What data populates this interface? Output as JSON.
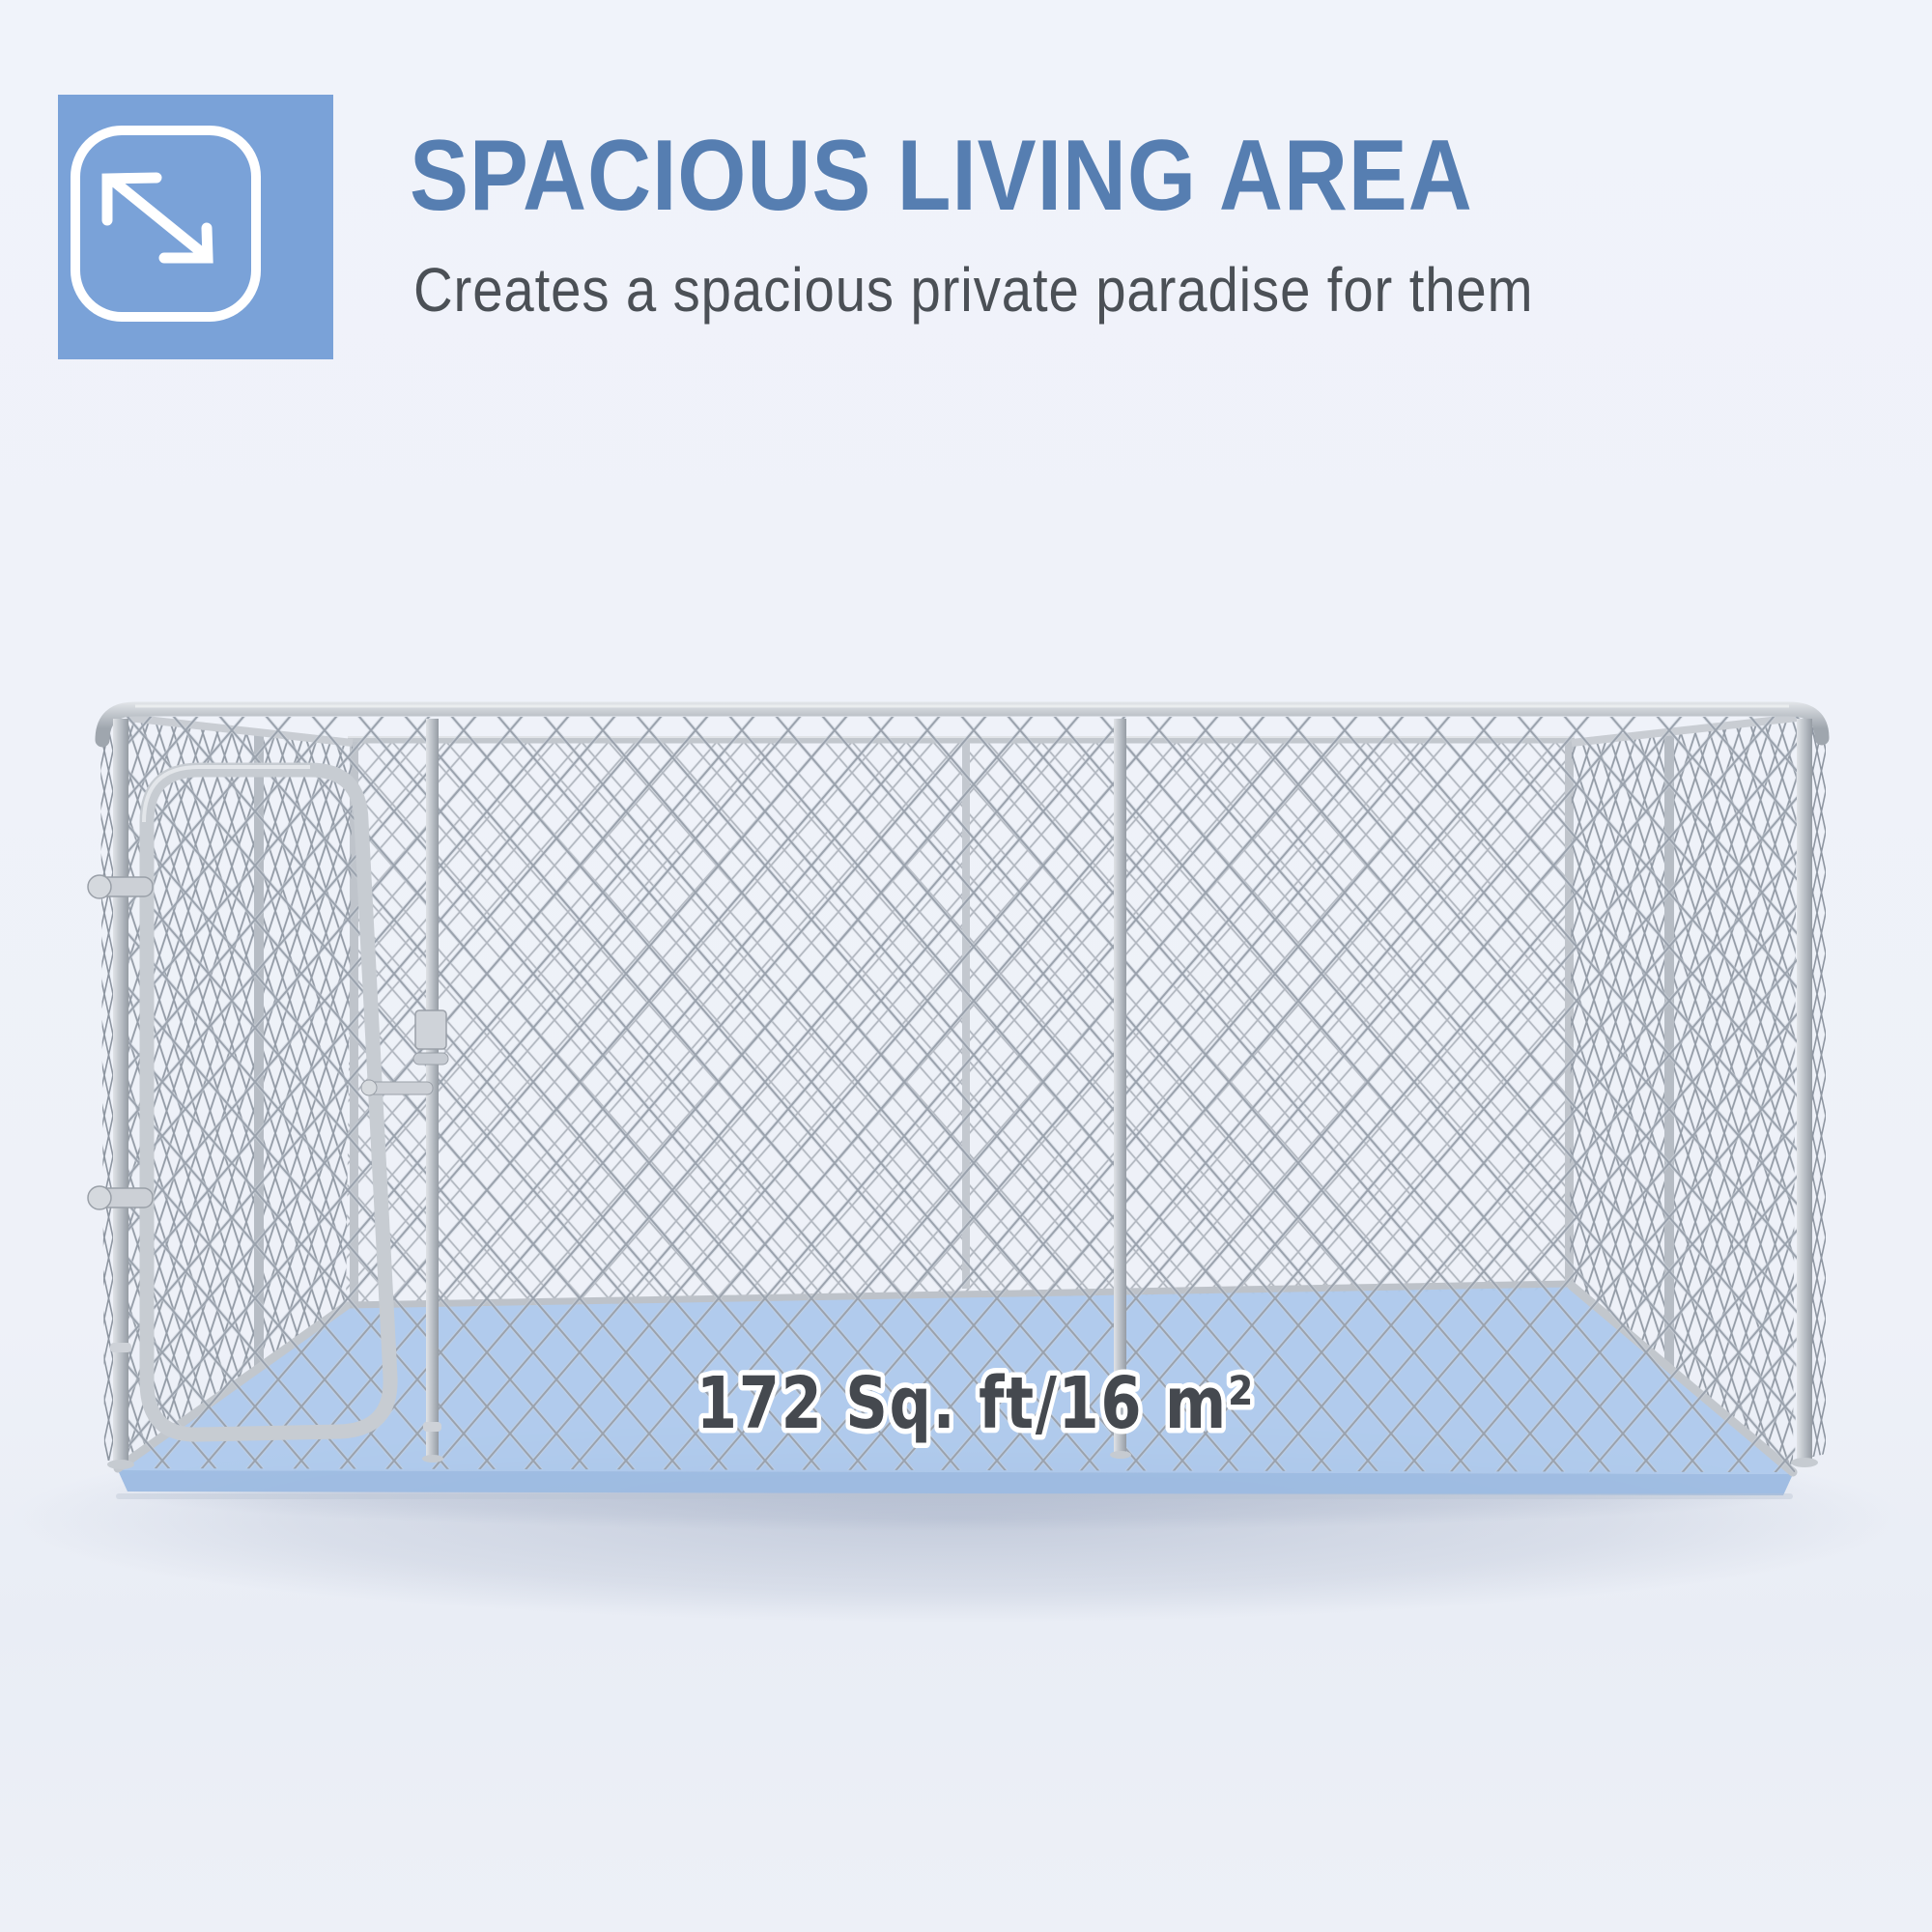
{
  "header": {
    "icon": "expand-arrows-icon",
    "title": "SPACIOUS LIVING AREA",
    "subtitle": "Creates a spacious private paradise for them"
  },
  "cage": {
    "area_label": "172 Sq. ft/16 m²"
  },
  "colors": {
    "accent_blue": "#7AA2D8",
    "title_blue": "#567EB1",
    "subtitle_gray": "#4B5056",
    "floor_blue": "#ABC8EC",
    "floor_edge_blue": "#9CBBE2",
    "metal_silver": "#C3C8CE",
    "label_gray": "#45494F",
    "background": "#EFF2F9"
  }
}
